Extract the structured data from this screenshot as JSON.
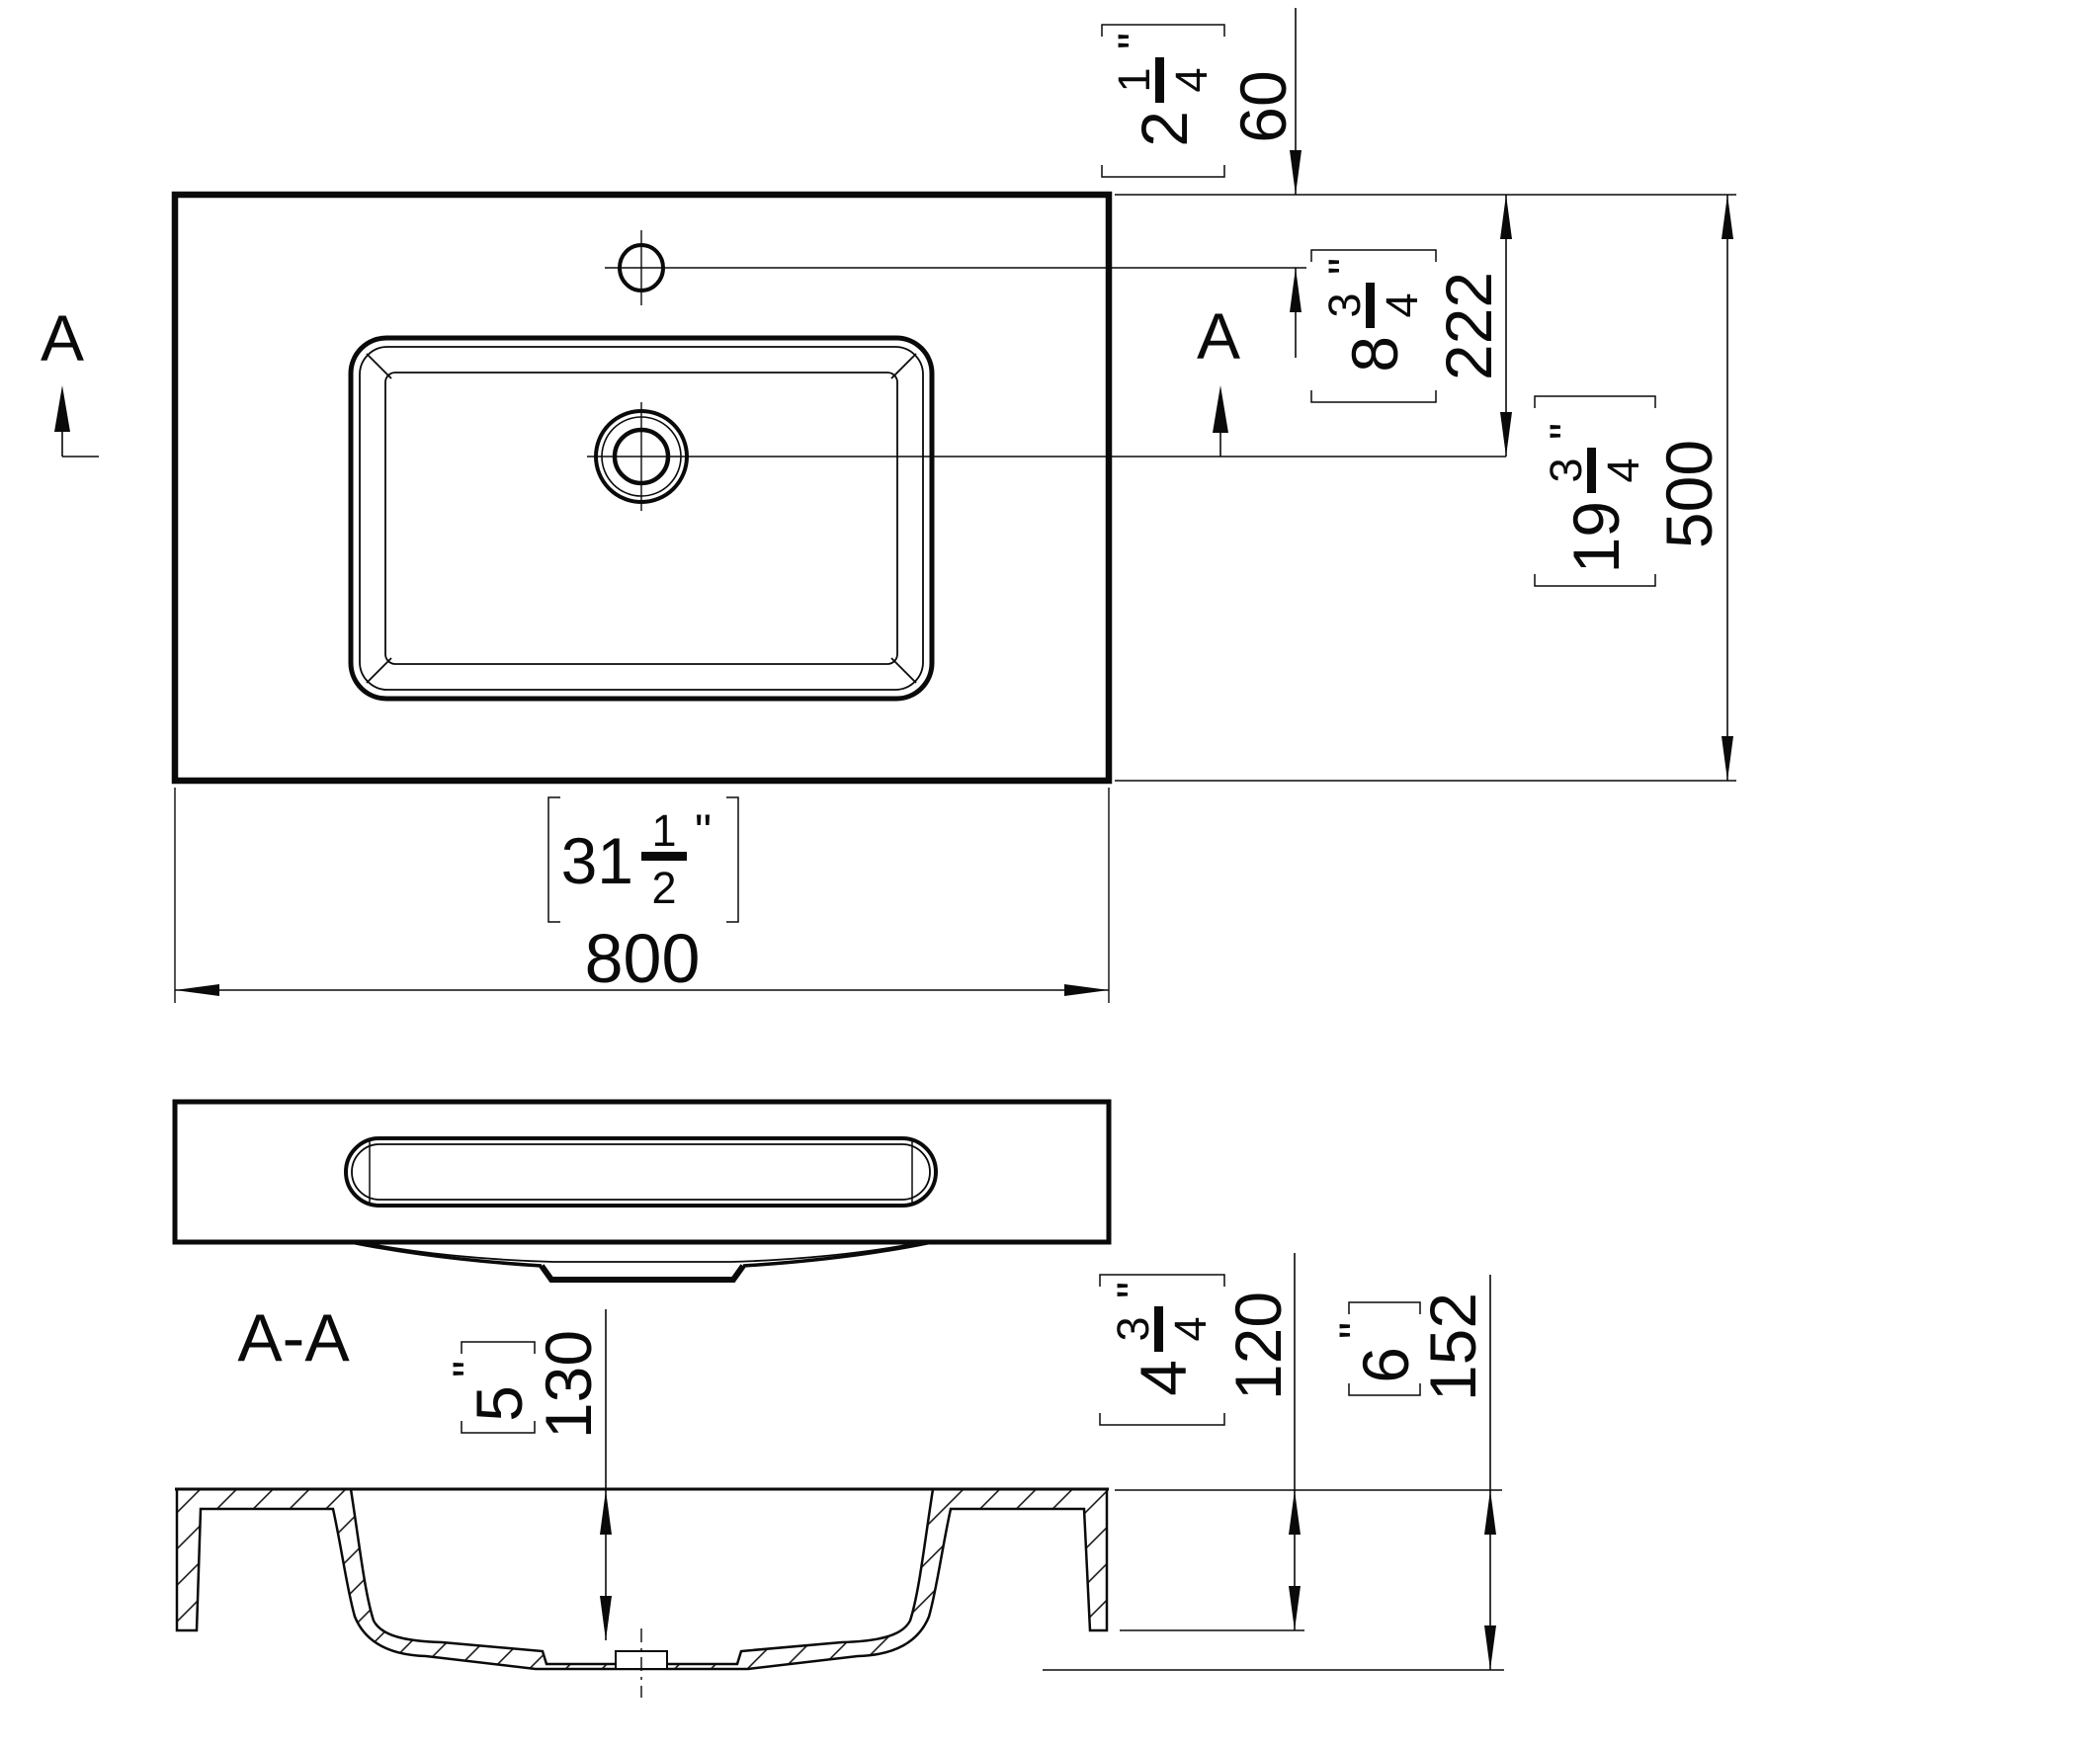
{
  "drawing": {
    "section_title": "A-A",
    "marker_left": "A",
    "marker_right": "A",
    "inch": "\"",
    "dims": {
      "width": {
        "inw": "31",
        "num": "1",
        "den": "2",
        "mm": "800"
      },
      "depth": {
        "inw": "19",
        "num": "3",
        "den": "4",
        "mm": "500"
      },
      "faucet": {
        "inw": "2",
        "num": "1",
        "den": "4",
        "mm": "60"
      },
      "drain": {
        "inw": "8",
        "num": "3",
        "den": "4",
        "mm": "222"
      },
      "basin_depth": {
        "inw": "5",
        "mm": "130"
      },
      "front_height": {
        "inw": "4",
        "num": "3",
        "den": "4",
        "mm": "120"
      },
      "total_height": {
        "inw": "6",
        "mm": "152"
      }
    }
  }
}
